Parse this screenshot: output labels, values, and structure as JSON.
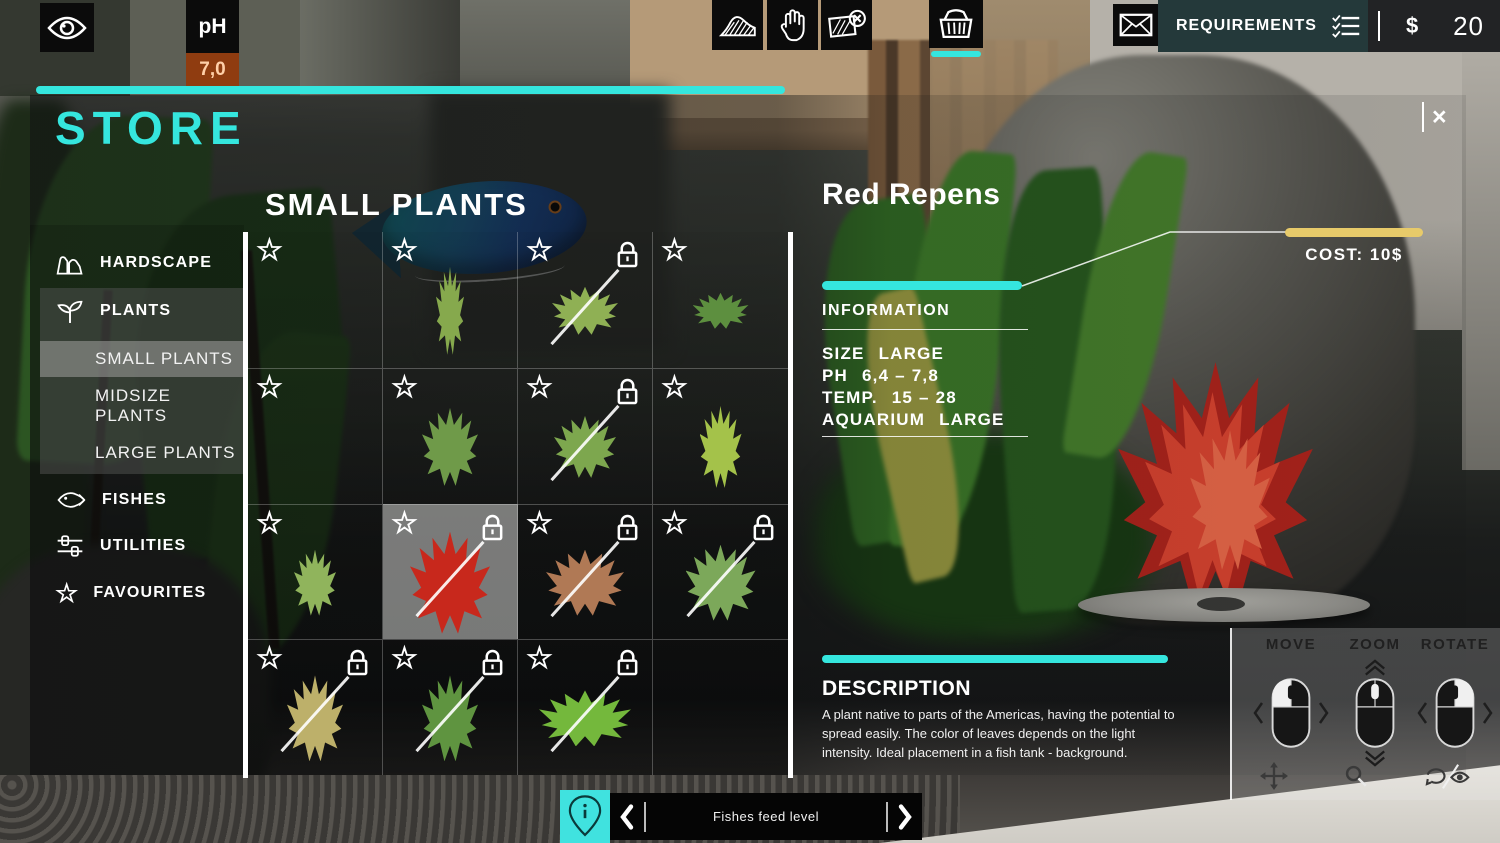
{
  "hud": {
    "ph": {
      "label": "pH",
      "value": "7,0"
    },
    "money": {
      "currency": "$",
      "amount": "20"
    },
    "requirements_label": "REQUIREMENTS",
    "accent_cyan": "#35e6de",
    "accent_gold": "#e7ca6a"
  },
  "icons": {
    "star_char": "☆"
  },
  "store": {
    "title": "STORE",
    "close_label": "×",
    "sidebar": {
      "items": [
        {
          "label": "HARDSCAPE",
          "icon": "rocks-icon"
        },
        {
          "label": "PLANTS",
          "icon": "plant-icon"
        },
        {
          "label": "SMALL PLANTS",
          "selected": true
        },
        {
          "label": "MIDSIZE PLANTS"
        },
        {
          "label": "LARGE PLANTS"
        },
        {
          "label": "FISHES",
          "icon": "fish-icon"
        },
        {
          "label": "UTILITIES",
          "icon": "sliders-icon"
        },
        {
          "label": "FAVOURITES",
          "icon": "star-icon"
        }
      ]
    },
    "grid": {
      "title": "SMALL PLANTS",
      "cells": [
        {
          "star": true,
          "lock": false,
          "slash": false,
          "selected": false,
          "plant_color": null
        },
        {
          "star": true,
          "lock": false,
          "slash": false,
          "selected": false,
          "plant_color": "#86a94d",
          "plant_w": 28,
          "plant_h": 88
        },
        {
          "star": true,
          "lock": true,
          "slash": true,
          "selected": false,
          "plant_color": "#8fb054",
          "plant_w": 66,
          "plant_h": 48
        },
        {
          "star": true,
          "lock": false,
          "slash": false,
          "selected": false,
          "plant_color": "#5d8f3f",
          "plant_w": 56,
          "plant_h": 36
        },
        {
          "star": true,
          "lock": false,
          "slash": false,
          "selected": false,
          "plant_color": null
        },
        {
          "star": true,
          "lock": false,
          "slash": false,
          "selected": false,
          "plant_color": "#6f9a49",
          "plant_w": 56,
          "plant_h": 78
        },
        {
          "star": true,
          "lock": true,
          "slash": true,
          "selected": false,
          "plant_color": "#7da74e",
          "plant_w": 62,
          "plant_h": 62
        },
        {
          "star": true,
          "lock": false,
          "slash": false,
          "selected": false,
          "plant_color": "#a4c24a",
          "plant_w": 42,
          "plant_h": 82
        },
        {
          "star": true,
          "lock": false,
          "slash": false,
          "selected": false,
          "plant_color": "#90b45c",
          "plant_w": 42,
          "plant_h": 66
        },
        {
          "star": true,
          "lock": true,
          "slash": true,
          "selected": true,
          "plant_color": "#c8281c",
          "plant_w": 80,
          "plant_h": 102
        },
        {
          "star": true,
          "lock": true,
          "slash": true,
          "selected": false,
          "plant_color": "#b07955",
          "plant_w": 78,
          "plant_h": 66
        },
        {
          "star": true,
          "lock": true,
          "slash": true,
          "selected": false,
          "plant_color": "#7ca85a",
          "plant_w": 70,
          "plant_h": 76
        },
        {
          "star": true,
          "lock": true,
          "slash": true,
          "selected": false,
          "plant_color": "#bdb06a",
          "plant_w": 56,
          "plant_h": 86
        },
        {
          "star": true,
          "lock": true,
          "slash": true,
          "selected": false,
          "plant_color": "#5f9440",
          "plant_w": 56,
          "plant_h": 86
        },
        {
          "star": true,
          "lock": true,
          "slash": true,
          "selected": false,
          "plant_color": "#74b83c",
          "plant_w": 92,
          "plant_h": 56
        },
        {
          "star": false,
          "lock": false,
          "slash": false,
          "selected": false,
          "plant_color": null
        }
      ]
    },
    "details": {
      "name": "Red Repens",
      "cost_label": "COST:",
      "cost_value": "10$",
      "information_title": "INFORMATION",
      "info_rows": [
        {
          "label": "SIZE",
          "value": "LARGE"
        },
        {
          "label": "PH",
          "value": "6,4 – 7,8"
        },
        {
          "label": "TEMP.",
          "value": "15 – 28"
        },
        {
          "label": "AQUARIUM",
          "value": "LARGE"
        }
      ],
      "description_title": "DESCRIPTION",
      "description_text": "A plant native to parts of the Americas, having the potential to spread easily. The color of leaves depends on the light intensity. Ideal placement in a fish tank - background."
    }
  },
  "bottom_bar": {
    "label": "Fishes feed level"
  },
  "controls": {
    "labels": [
      "MOVE",
      "ZOOM",
      "ROTATE"
    ]
  }
}
